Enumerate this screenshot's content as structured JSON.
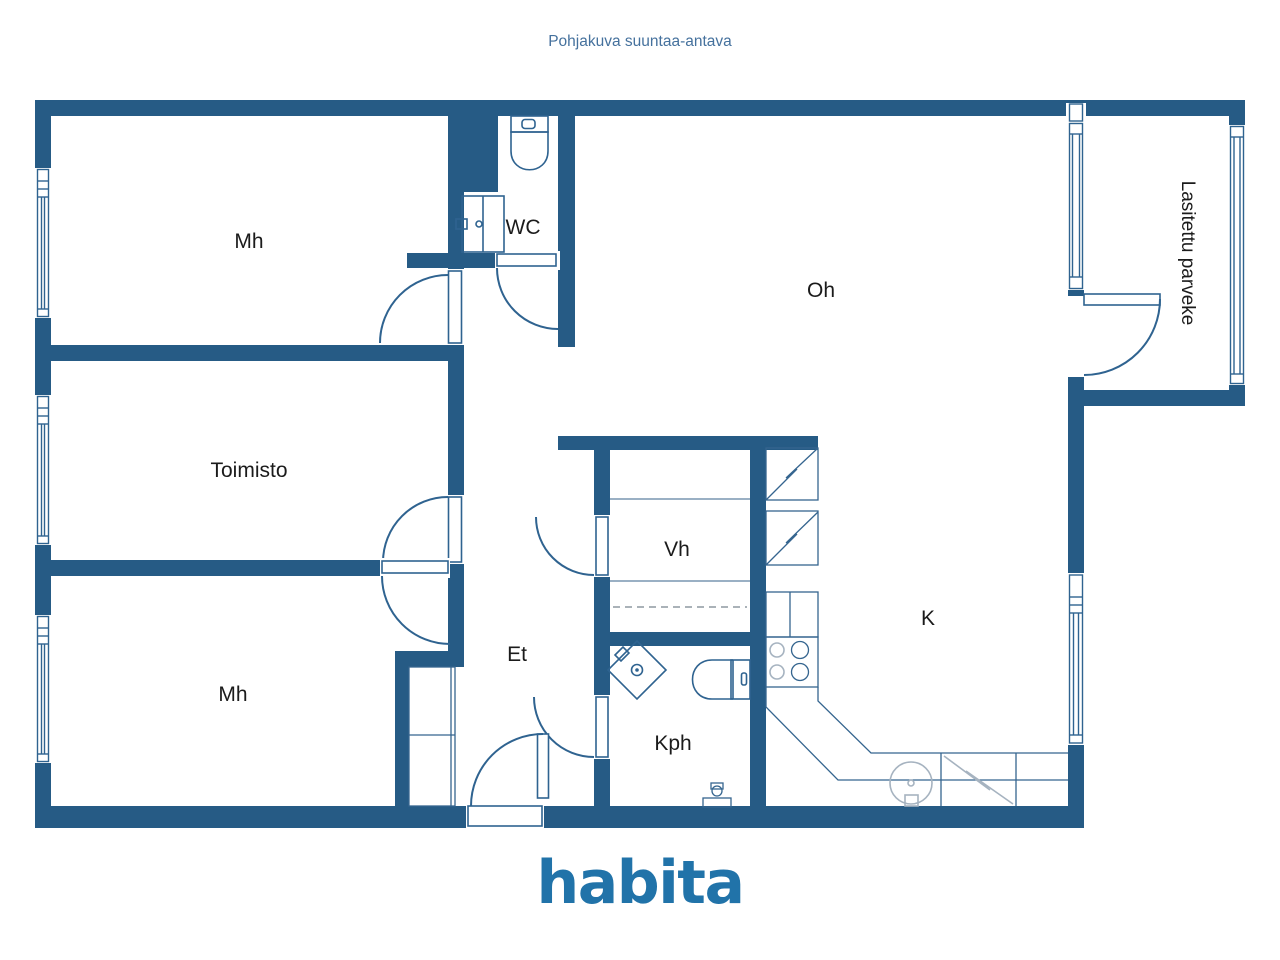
{
  "title": "Pohjakuva suuntaa-antava",
  "logo": "habita",
  "rooms": {
    "mh_top": "Mh",
    "wc": "WC",
    "oh": "Oh",
    "toimisto": "Toimisto",
    "vh": "Vh",
    "k": "K",
    "mh_bottom": "Mh",
    "et": "Et",
    "kph": "Kph",
    "balcony": "Lasitettu parveke"
  },
  "colors": {
    "wall": "#265b85",
    "line": "#2f6390",
    "light_line": "#a6b3c0",
    "label_text": "#1b1b1b",
    "title_text": "#45719d",
    "logo_blue": "#2173a9",
    "background": "#ffffff"
  }
}
